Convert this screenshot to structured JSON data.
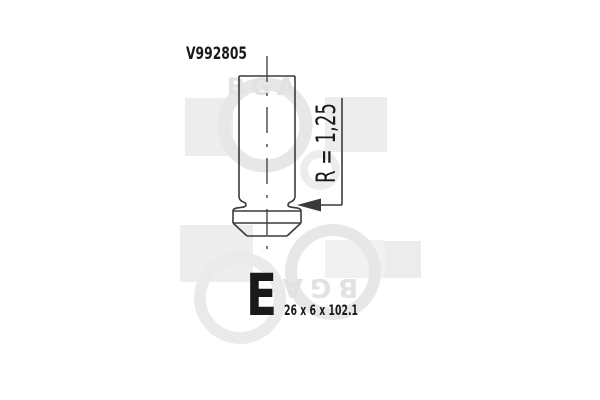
{
  "page": {
    "background_color": "#ffffff"
  },
  "drawing": {
    "part_number": "V992805",
    "radius_label": "R = 1,25",
    "type_letter": "E",
    "dimensions": "26 x 6 x 102.1",
    "line_color": "#3a3a3a",
    "text_color": "#1a1a1a"
  },
  "watermark": {
    "brand": "BGA",
    "ring_color": "#e7e7e7",
    "square_color": "#ededed",
    "text_color": "#e2e2e2"
  }
}
